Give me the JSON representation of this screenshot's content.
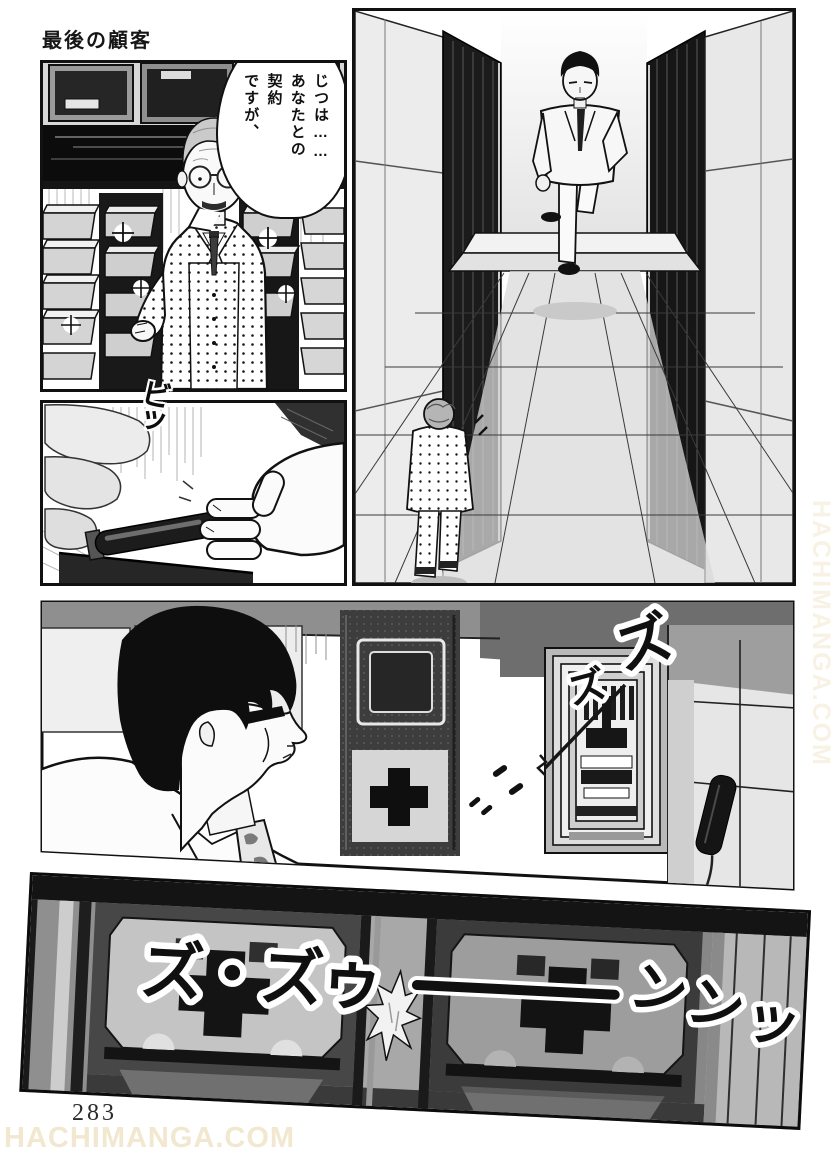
{
  "page": {
    "title": "最後の顧客",
    "page_number": "283",
    "ink_color": "#111111",
    "paper_color": "#ffffff"
  },
  "watermark": {
    "bottom_text": "HACHIMANGA.COM",
    "side_text": "HACHIMANGA.COM",
    "color": "#f2e7cf"
  },
  "panel1": {
    "speech_bubble_text": "じつは……\nあなたとの\n契約\nですが、"
  },
  "panel3": {
    "sfx_grab": "ビッ"
  },
  "panel4": {
    "sfx_zu_big": "ズ",
    "sfx_zu_small": "ズ"
  },
  "panel5": {
    "sfx_rumble_left": "ズ・ズゥ",
    "sfx_rumble_right": "ンンッ"
  }
}
